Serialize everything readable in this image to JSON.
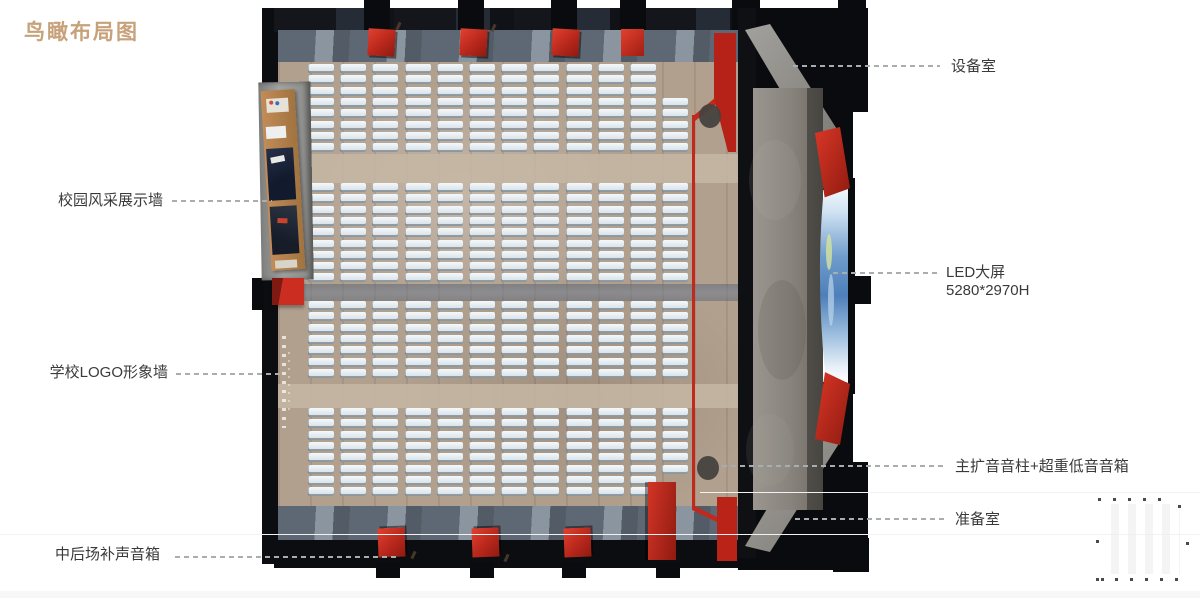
{
  "title": "鸟瞰布局图",
  "callouts": {
    "equipment_room": "设备室",
    "led_screen": "LED大屏",
    "led_screen_size": "5280*2970H",
    "main_pa": "主扩音音柱+超重低音音箱",
    "prep_room": "准备室",
    "display_wall": "校园风采展示墙",
    "logo_wall": "学校LOGO形象墙",
    "rear_speakers": "中后场补声音箱"
  },
  "colors": {
    "title_text": "#c7a17a",
    "label_text": "#3a3a3a",
    "leader_line": "#a8adb1",
    "accent_red": "#c1281e",
    "wall_black": "#0c0d10",
    "wood_floor": "#b2a08f",
    "walkway_gray": "#5d6874",
    "seat_white": "#e7edf2",
    "stage_gray": "#8f8b85",
    "led_blue": "#4d7fba"
  },
  "seating": {
    "columns": 12,
    "blocks": [
      8,
      9,
      7,
      8
    ]
  }
}
